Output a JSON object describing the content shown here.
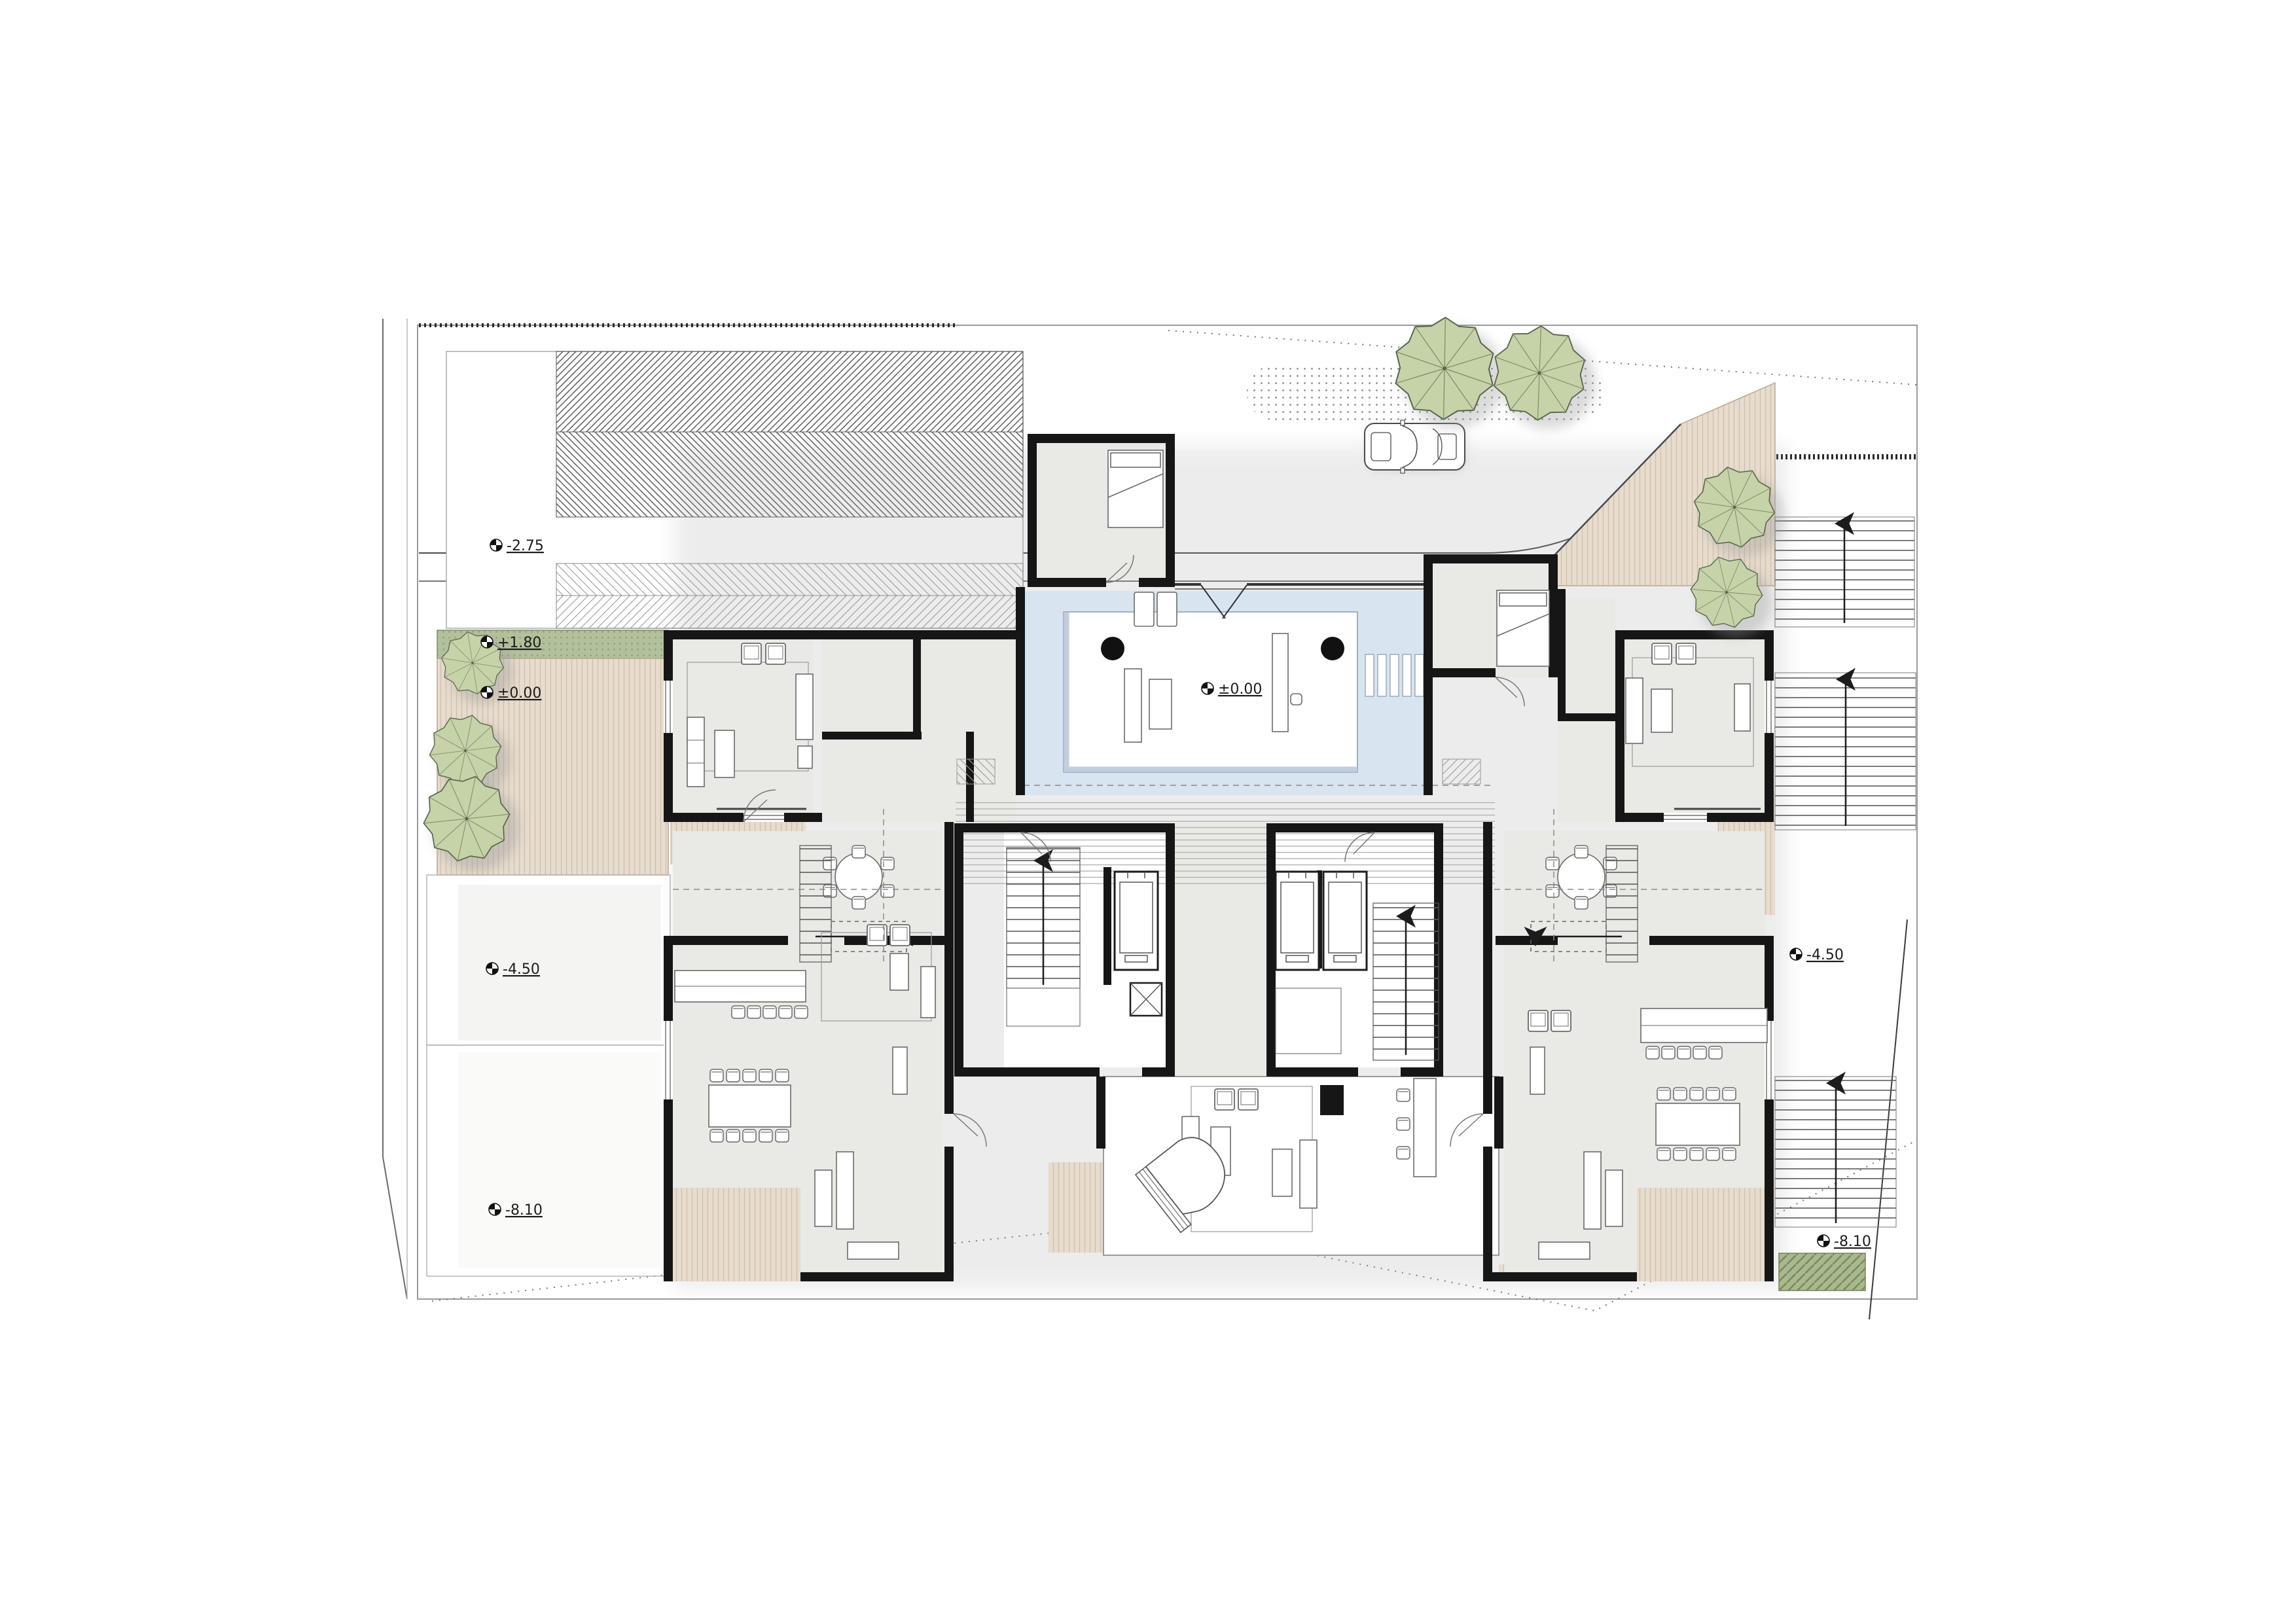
{
  "drawing": {
    "type": "architectural site / floor plan",
    "levels": {
      "upper_left_lot": "-2.75",
      "left_garden_strip": "+1.80",
      "left_terrace": "±0.00",
      "courtyard_pool_deck": "±0.00",
      "left_lot_mid": "-4.50",
      "left_lot_low": "-8.10",
      "east_stairs_mid": "-4.50",
      "east_stairs_low": "-8.10"
    },
    "colors": {
      "wall": "#161616",
      "floor": "#e9e9e5",
      "deck_wood": "#e7dccd",
      "deck_stripe": "#cfbfa9",
      "pool_water": "#d8e4f0",
      "pool_edge": "#9fb0c2",
      "planting_green": "#b2c09c",
      "planting_hatch_green": "#a9b88f",
      "tree_fill": "#c6d3a9",
      "tree_stroke": "#55644a",
      "site_line": "#8a8a8a",
      "stair_line": "#555555"
    },
    "inventory": {
      "trees": 7,
      "elevators": 3,
      "stair_cores": 2,
      "exterior_stair_flights": 3,
      "apartments": 2,
      "grand_piano": 1,
      "car": 1,
      "pool": 1
    }
  }
}
